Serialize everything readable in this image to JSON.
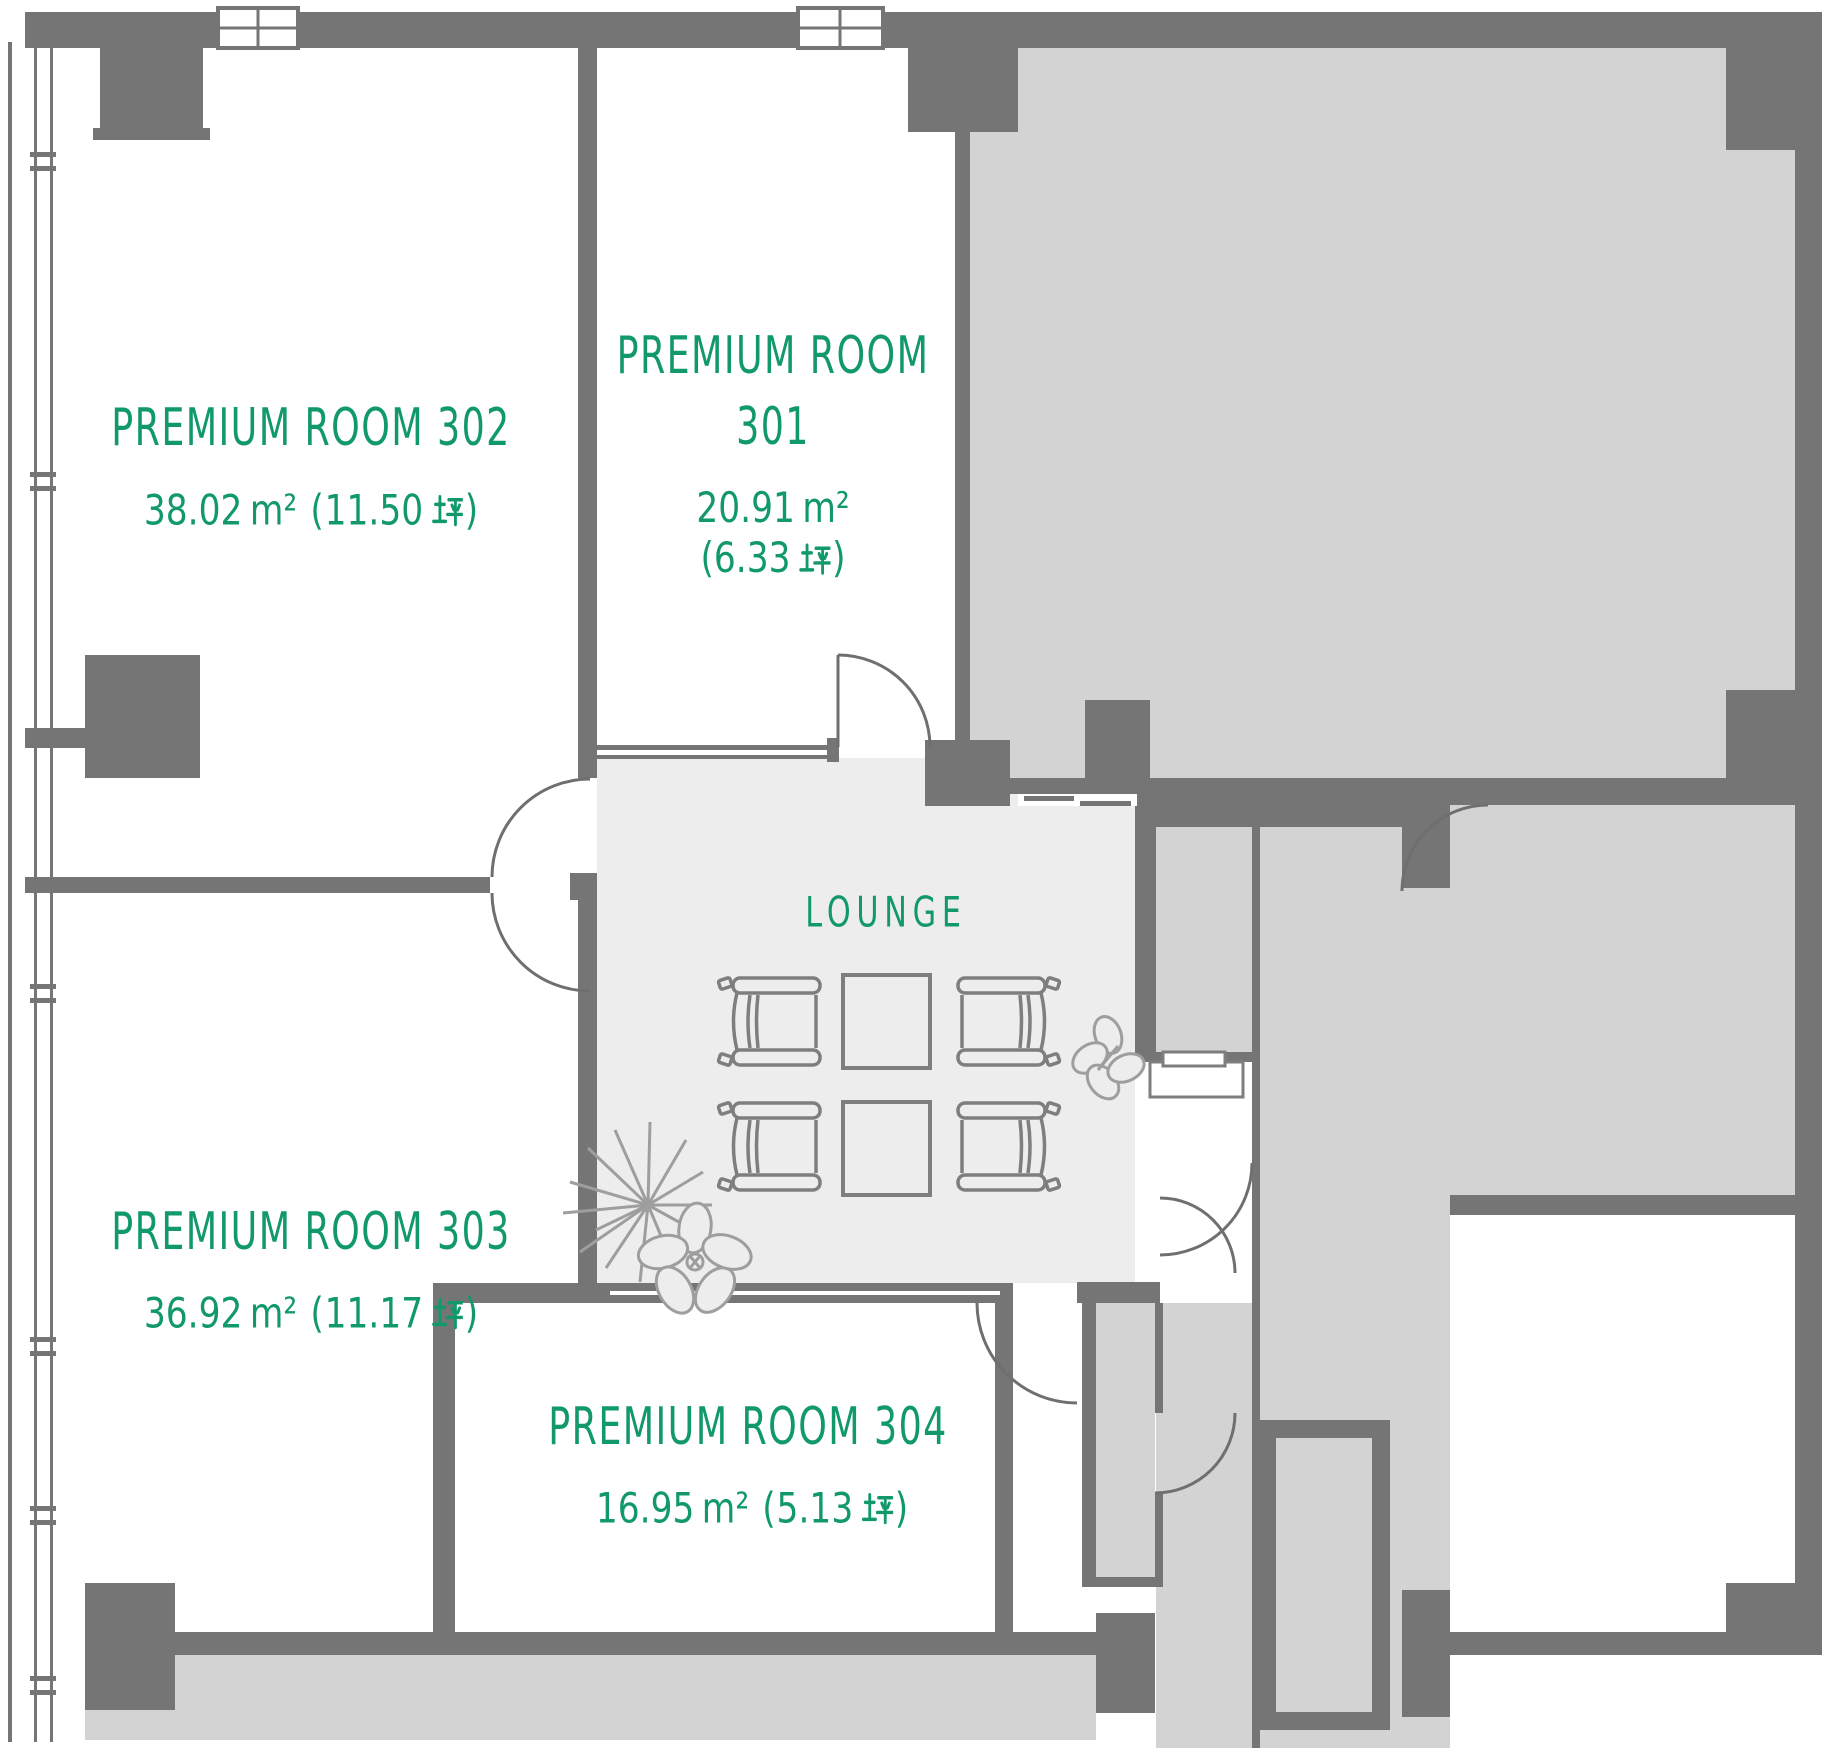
{
  "rooms": {
    "r301": {
      "name_line1": "PREMIUM ROOM",
      "name_line2": "301",
      "area_m2": "20.91",
      "area_tsubo": "6.33"
    },
    "r302": {
      "name": "PREMIUM ROOM 302",
      "area_m2": "38.02",
      "area_tsubo": "11.50"
    },
    "r303": {
      "name": "PREMIUM ROOM 303",
      "area_m2": "36.92",
      "area_tsubo": "11.17"
    },
    "r304": {
      "name": "PREMIUM ROOM 304",
      "area_m2": "16.95",
      "area_tsubo": "5.13"
    }
  },
  "lounge": {
    "name": "LOUNGE"
  },
  "units": {
    "square_meters": "m²",
    "square_meters_glyph": "㎡",
    "tsubo": "坪",
    "open_paren": "(",
    "close_paren": ")"
  },
  "colors": {
    "accent_green": "#12996a",
    "wall_gray": "#757575",
    "room_fill": "#d3d3d3",
    "lounge_fill": "#ededed"
  }
}
